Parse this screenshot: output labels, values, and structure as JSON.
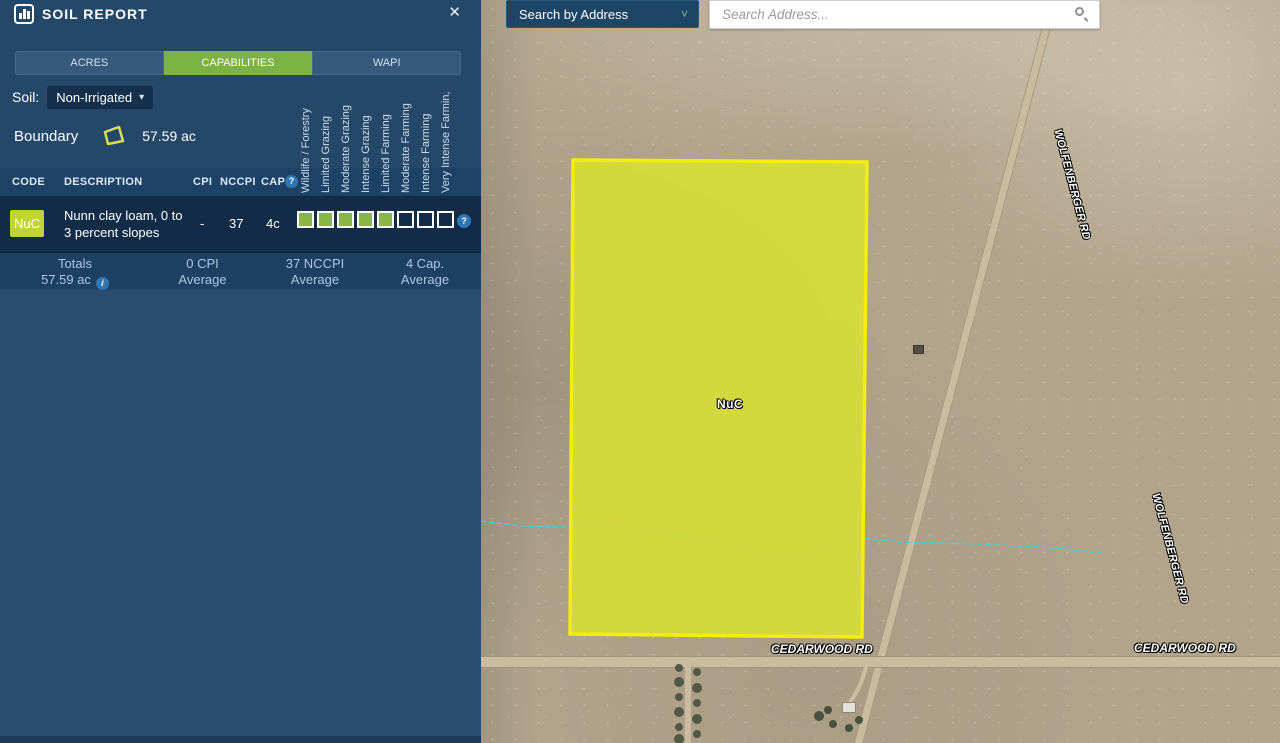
{
  "panel": {
    "title": "SOIL REPORT",
    "close_label": "✕",
    "tabs": [
      {
        "label": "ACRES",
        "active": false
      },
      {
        "label": "CAPABILITIES",
        "active": true
      },
      {
        "label": "WAPI",
        "active": false
      }
    ],
    "soil_label": "Soil:",
    "soil_value": "Non-Irrigated",
    "boundary_label": "Boundary",
    "boundary_area": "57.59 ac",
    "table": {
      "columns": {
        "code": "CODE",
        "description": "DESCRIPTION",
        "cpi": "CPI",
        "nccpi": "NCCPI",
        "cap": "CAP"
      },
      "capability_columns": [
        "Wildlife / Forestry",
        "Limited Grazing",
        "Moderate Grazing",
        "Intense Grazing",
        "Limited Farming",
        "Moderate Farming",
        "Intense Farming",
        "Very Intense Farmin,"
      ],
      "rows": [
        {
          "code": "NuC",
          "description_line1": "Nunn clay loam, 0 to",
          "description_line2": "3 percent slopes",
          "cpi": "-",
          "nccpi": "37",
          "cap": "4c",
          "capability_filled": 5,
          "capability_total": 8
        }
      ],
      "totals": {
        "col1_line1": "Totals",
        "col1_line2": "57.59 ac",
        "col2_line1": "0 CPI",
        "col2_line2": "Average",
        "col3_line1": "37 NCCPI",
        "col3_line2": "Average",
        "col4_line1": "4 Cap.",
        "col4_line2": "Average"
      }
    }
  },
  "map": {
    "search_type_value": "Search by Address",
    "search_placeholder": "Search Address...",
    "parcel_label": "NuC",
    "road_labels": {
      "wolfenberger": "WOLFENBERGER RD",
      "cedarwood": "CEDARWOOD RD"
    },
    "colors": {
      "accent_green": "#7cb342",
      "parcel_fill": "#d6dd39",
      "parcel_stroke": "#f2ee07",
      "stream": "#53c6d8",
      "panel_bg": "#254768",
      "row_bg": "#122c48",
      "code_badge": "#c1d437"
    }
  }
}
